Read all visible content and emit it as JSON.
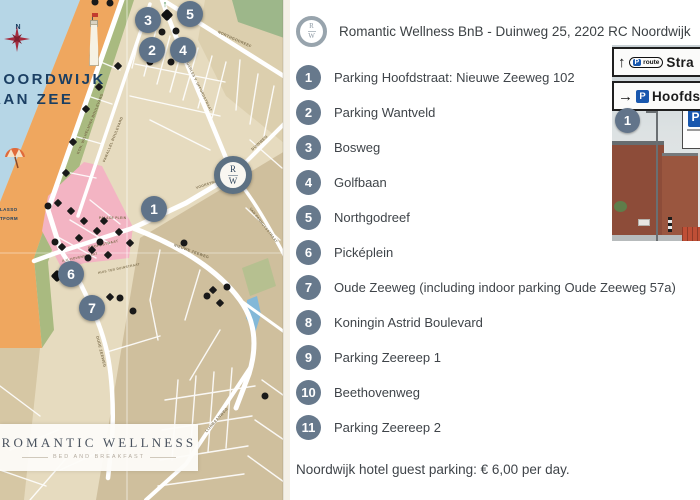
{
  "header": {
    "logo_top": "R",
    "logo_bottom": "W",
    "title": "Romantic Wellness BnB - Duinweg 25, 2202 RC Noordwijk"
  },
  "legend": {
    "items": [
      {
        "number": "1",
        "label": "Parking Hoofdstraat: Nieuwe Zeeweg 102"
      },
      {
        "number": "2",
        "label": "Parking Wantveld"
      },
      {
        "number": "3",
        "label": "Bosweg"
      },
      {
        "number": "4",
        "label": "Golfbaan"
      },
      {
        "number": "5",
        "label": "Northgodreef"
      },
      {
        "number": "6",
        "label": "Picképlein"
      },
      {
        "number": "7",
        "label": "Oude Zeeweg (including indoor parking Oude Zeeweg 57a)"
      },
      {
        "number": "8",
        "label": "Koningin Astrid Boulevard"
      },
      {
        "number": "9",
        "label": "Parking Zeereep 1"
      },
      {
        "number": "10",
        "label": "Beethovenweg"
      },
      {
        "number": "11",
        "label": "Parking Zeereep 2"
      }
    ],
    "footnote": "Noordwijk hotel guest parking: € 6,00 per day."
  },
  "map": {
    "place_line1": "NOORDWIJK",
    "place_line2": "AAN ZEE",
    "compass_label": "N",
    "side_labels": [
      "LASSO",
      "TFORM"
    ],
    "center_marker": {
      "top": "R",
      "bottom": "W"
    },
    "brand_box": {
      "title": "ROMANTIC WELLNESS",
      "subtitle": "BED AND BREAKFAST"
    },
    "markers": [
      {
        "n": "1",
        "x": 154,
        "y": 209
      },
      {
        "n": "2",
        "x": 152,
        "y": 50
      },
      {
        "n": "3",
        "x": 148,
        "y": 20
      },
      {
        "n": "4",
        "x": 183,
        "y": 50
      },
      {
        "n": "5",
        "x": 190,
        "y": 14
      },
      {
        "n": "6",
        "x": 71,
        "y": 274
      },
      {
        "n": "7",
        "x": 92,
        "y": 308
      }
    ],
    "street_labels": [
      {
        "text": "KON. WILHELMINA BOULEVARD",
        "x": 78,
        "y": 152,
        "r": -68,
        "s": 3.6
      },
      {
        "text": "PARALLEL BOULEVARD",
        "x": 104,
        "y": 160,
        "r": -68,
        "s": 3.6
      },
      {
        "text": "QUARLES V. UFFORDSTRAAT",
        "x": 186,
        "y": 58,
        "r": 64,
        "s": 3.4
      },
      {
        "text": "NORTHGODREEF",
        "x": 218,
        "y": 30,
        "r": 24,
        "s": 3.8
      },
      {
        "text": "DUINWEG",
        "x": 252,
        "y": 148,
        "r": -42,
        "s": 3.8
      },
      {
        "text": "VAN PANHUYSSTRAAT",
        "x": 250,
        "y": 206,
        "r": 52,
        "s": 3.4
      },
      {
        "text": "VOORSTRAAT",
        "x": 196,
        "y": 186,
        "r": -18,
        "s": 3.4
      },
      {
        "text": "PALACE PLEIN",
        "x": 99,
        "y": 216,
        "r": 0,
        "s": 3.2
      },
      {
        "text": "HOOFDSTRAAT",
        "x": 88,
        "y": 246,
        "r": -13,
        "s": 3.6
      },
      {
        "text": "A.V. HOVENSTRAAT",
        "x": 62,
        "y": 259,
        "r": -12,
        "s": 3.2
      },
      {
        "text": "HUIS TER DUINSTRAAT",
        "x": 98,
        "y": 271,
        "r": -12,
        "s": 3.2
      },
      {
        "text": "NIEUWE ZEEWEG",
        "x": 174,
        "y": 243,
        "r": 20,
        "s": 3.8
      },
      {
        "text": "OUDE ZEEWEG",
        "x": 97,
        "y": 334,
        "r": 76,
        "s": 3.8
      },
      {
        "text": "LIJNBAANWEG",
        "x": 206,
        "y": 430,
        "r": -48,
        "s": 3.8
      }
    ],
    "icons": [
      {
        "t": "dot",
        "x": 95,
        "y": 2
      },
      {
        "t": "dot",
        "x": 110,
        "y": 3
      },
      {
        "t": "uparrow",
        "x": 165,
        "y": 4
      },
      {
        "t": "bigdiamond",
        "x": 167,
        "y": 15
      },
      {
        "t": "dot",
        "x": 162,
        "y": 32
      },
      {
        "t": "dot",
        "x": 176,
        "y": 31
      },
      {
        "t": "dot",
        "x": 150,
        "y": 62
      },
      {
        "t": "dot",
        "x": 171,
        "y": 62
      },
      {
        "t": "diamond",
        "x": 118,
        "y": 66
      },
      {
        "t": "diamond",
        "x": 99,
        "y": 87
      },
      {
        "t": "diamond",
        "x": 86,
        "y": 109
      },
      {
        "t": "diamond",
        "x": 73,
        "y": 142
      },
      {
        "t": "diamond",
        "x": 66,
        "y": 173
      },
      {
        "t": "diamond",
        "x": 58,
        "y": 203
      },
      {
        "t": "dot",
        "x": 48,
        "y": 206
      },
      {
        "t": "diamond",
        "x": 71,
        "y": 211
      },
      {
        "t": "diamond",
        "x": 84,
        "y": 221
      },
      {
        "t": "diamond",
        "x": 104,
        "y": 221
      },
      {
        "t": "diamond",
        "x": 97,
        "y": 231
      },
      {
        "t": "diamond",
        "x": 119,
        "y": 232
      },
      {
        "t": "diamond",
        "x": 79,
        "y": 238
      },
      {
        "t": "dot",
        "x": 55,
        "y": 242
      },
      {
        "t": "dot",
        "x": 100,
        "y": 242
      },
      {
        "t": "diamond",
        "x": 62,
        "y": 247
      },
      {
        "t": "diamond",
        "x": 92,
        "y": 250
      },
      {
        "t": "diamond",
        "x": 108,
        "y": 255
      },
      {
        "t": "dot",
        "x": 88,
        "y": 258
      },
      {
        "t": "diamond",
        "x": 130,
        "y": 243
      },
      {
        "t": "dot",
        "x": 120,
        "y": 298
      },
      {
        "t": "diamond",
        "x": 110,
        "y": 297
      },
      {
        "t": "dot",
        "x": 133,
        "y": 311
      },
      {
        "t": "dot",
        "x": 184,
        "y": 243
      },
      {
        "t": "bigdiamond",
        "x": 57,
        "y": 276
      },
      {
        "t": "diamond",
        "x": 213,
        "y": 290
      },
      {
        "t": "dot",
        "x": 227,
        "y": 287
      },
      {
        "t": "diamond",
        "x": 220,
        "y": 303
      },
      {
        "t": "dot",
        "x": 207,
        "y": 296
      },
      {
        "t": "dot",
        "x": 265,
        "y": 396
      }
    ],
    "colors": {
      "marker_slate": "#5f7389",
      "navy": "#1b3f63",
      "pink_zone": "#f3b4c3",
      "sea": "#b6d6e6",
      "beach": "#efa75f",
      "dune": "#a9ba80",
      "town": "#e6dbbf",
      "town_dark": "#cfbf9d",
      "road": "#ffffff"
    }
  },
  "photo": {
    "sign1": {
      "arrow": "↑",
      "badge": "P",
      "badge_suffix": "route",
      "text": "Stra"
    },
    "sign2": {
      "arrow": "→",
      "badge": "P",
      "text": "Hoofdst"
    },
    "marker": "1",
    "parking_sign": "P"
  }
}
